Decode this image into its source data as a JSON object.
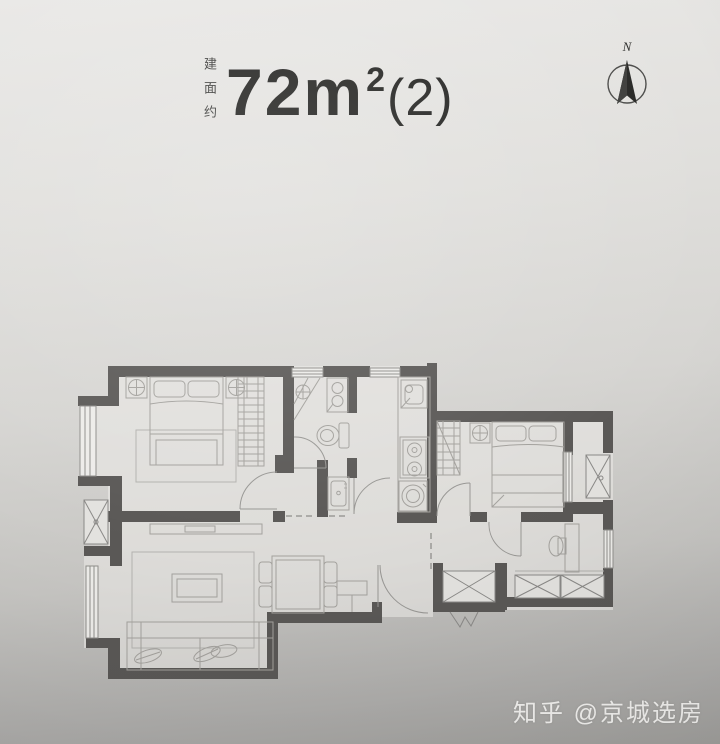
{
  "header": {
    "area_prefix_vertical": "建面约",
    "area_main": "72m",
    "area_sup": "2",
    "area_suffix": "(2)"
  },
  "compass": {
    "label": "N"
  },
  "watermark": {
    "text": "知乎 @京城选房"
  },
  "colors": {
    "paper_top": "#e9e8e6",
    "paper_bottom": "#a2a19e",
    "wall": "#5a5856",
    "furniture_line": "#a3a19d",
    "title_text": "#222220",
    "watermark_text": "#f8f7f4"
  },
  "floorplan": {
    "type": "apartment-floor-plan",
    "area_label": "72m2(2)",
    "elements": [
      "master-bedroom",
      "double-bed",
      "pillows",
      "nightstand-lamps",
      "wardrobe",
      "living-room",
      "sofa",
      "coffee-table",
      "rug",
      "tv-console",
      "dining-table",
      "dining-chairs",
      "bathroom",
      "shower-drain",
      "toilet",
      "washbasin",
      "vanity",
      "kitchen",
      "kitchen-sink",
      "two-burner-stove",
      "washing-machine",
      "second-bedroom",
      "second-bed",
      "second-wardrobe",
      "study-room",
      "desk",
      "storage-cabinets",
      "entry-door",
      "equipment-platform-left",
      "equipment-platform-right",
      "entry-closet",
      "windows",
      "door-swings",
      "compass-north"
    ]
  }
}
